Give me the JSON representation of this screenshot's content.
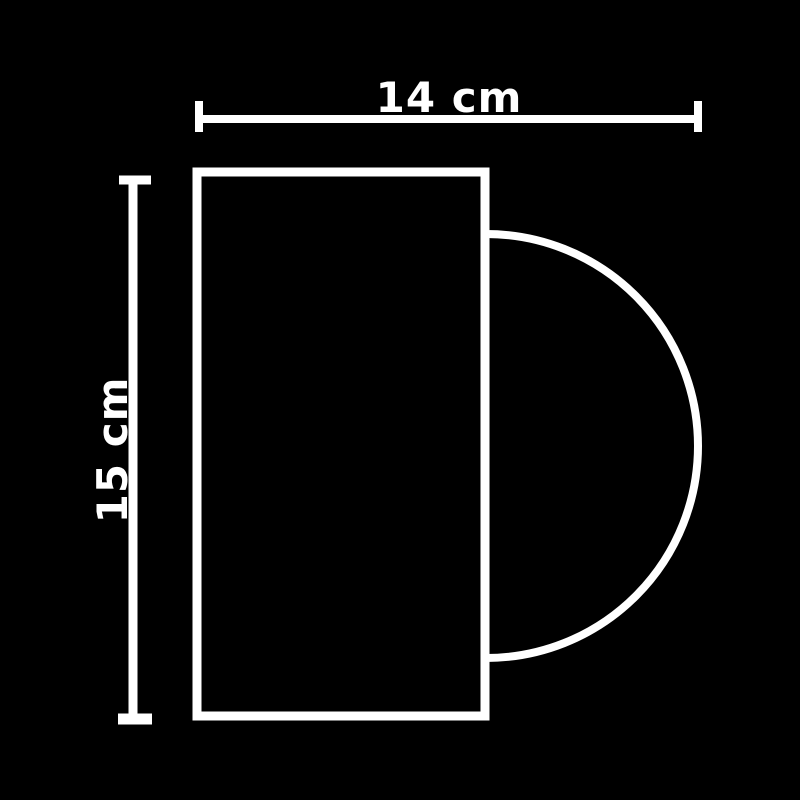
{
  "diagram": {
    "title": "rectangle with semicircle on right side",
    "background_color": "#000000",
    "line_color": "#ffffff",
    "width_dimension": {
      "label": "14 cm",
      "orientation": "horizontal-top"
    },
    "height_dimension": {
      "label": "15 cm",
      "orientation": "vertical-left-rotated"
    }
  }
}
